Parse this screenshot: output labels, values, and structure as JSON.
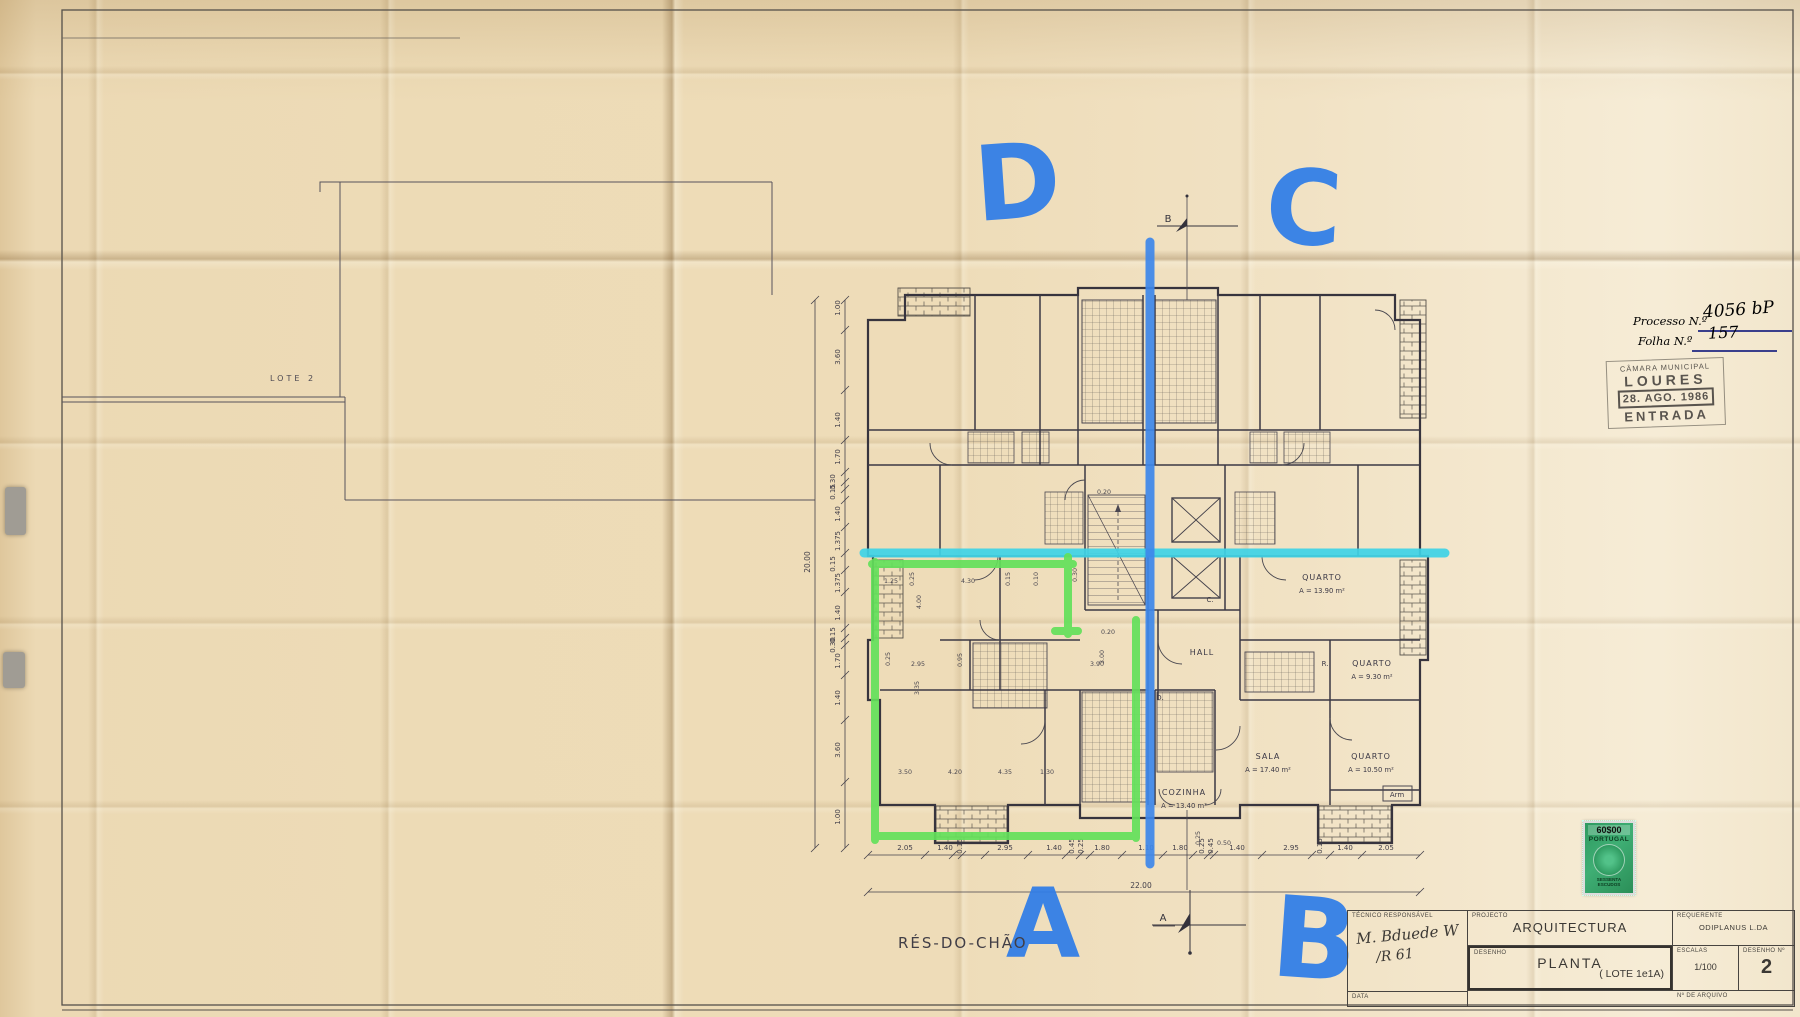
{
  "labels": {
    "floor": "RÉS-DO-CHÃO",
    "site": "LOTE 2"
  },
  "annotations": {
    "marker_color": "#2f7de8",
    "cyan_color": "#3ed3e6",
    "green_color": "#63e05a",
    "letters": {
      "d": "D",
      "c": "C",
      "a": "A",
      "b": "B"
    }
  },
  "section_markers": {
    "top": "B",
    "bottom": "A"
  },
  "plan_marks": {
    "c": "C.",
    "d": "D.",
    "r": "R."
  },
  "rooms": {
    "quarto1": {
      "name": "QUARTO",
      "area": "A = 13.90 m²"
    },
    "quarto2": {
      "name": "QUARTO",
      "area": "A = 9.30 m²"
    },
    "sala": {
      "name": "SALA",
      "area": "A = 17.40 m²"
    },
    "quarto3": {
      "name": "QUARTO",
      "area": "A = 10.50 m²"
    },
    "cozinha": {
      "name": "COZINHA",
      "area": "A = 13.40 m²"
    },
    "hall": {
      "name": "HALL"
    },
    "arm": {
      "name": "Arm"
    }
  },
  "dims": {
    "bottom": [
      "2.05",
      "1.40",
      "0.15",
      "2.95",
      "1.40",
      "0.45",
      "0.25",
      "1.80",
      "1.10",
      "1.80",
      "0.25",
      "0.45",
      "1.40",
      "2.95",
      "0.15",
      "1.40",
      "2.05"
    ],
    "bottom_total": "22.00",
    "left": [
      "1.00",
      "3.60",
      "1.40",
      "1.70",
      "0.30",
      "0.15",
      "1.40",
      "1.375",
      "0.15",
      "1.375",
      "1.40",
      "0.15",
      "0.30",
      "1.70",
      "1.40",
      "3.60",
      "1.00"
    ],
    "left_total": "20.00",
    "interior": [
      "1.25",
      "0.25",
      "4.30",
      "0.15",
      "0.10",
      "0.30",
      "4.00",
      "0.25",
      "2.95",
      "0.95",
      "3.35",
      "0.20",
      "3.00",
      "3.90",
      "0.20",
      "3.50",
      "4.20",
      "4.35",
      "1.30",
      "0.25",
      "0.50"
    ]
  },
  "process": {
    "processo_label": "Processo N.º",
    "processo_value": "4056 bP",
    "folha_label": "Folha N.º",
    "folha_value": "157"
  },
  "entry_stamp": {
    "line1": "CÂMARA MUNICIPAL",
    "line2": "LOURES",
    "date": "28. AGO. 1986",
    "line4": "ENTRADA"
  },
  "revenue_stamp": {
    "value": "60$00",
    "country": "PORTUGAL",
    "denomination_1": "SESSENTA",
    "denomination_2": "ESCUDOS"
  },
  "title_block": {
    "tecnico_label": "TÉCNICO RESPONSÁVEL",
    "tecnico_signature": "M. Bduede W",
    "tecnico_signature2": "/R 61",
    "projecto_label": "PROJECTO",
    "projecto_value": "ARQUITECTURA",
    "requerente_label": "REQUERENTE",
    "requerente_value": "ODIPLANUS  L.DA",
    "desenho_label": "DESENHO",
    "desenho_value": "PLANTA",
    "desenho_extra": "( LOTE  1e1A)",
    "escalas_label": "ESCALAS",
    "escalas_value": "1/100",
    "numero_label": "DESENHO Nº",
    "numero_value": "2",
    "data_label": "DATA",
    "arquivo_label": "Nº DE ARQUIVO"
  }
}
